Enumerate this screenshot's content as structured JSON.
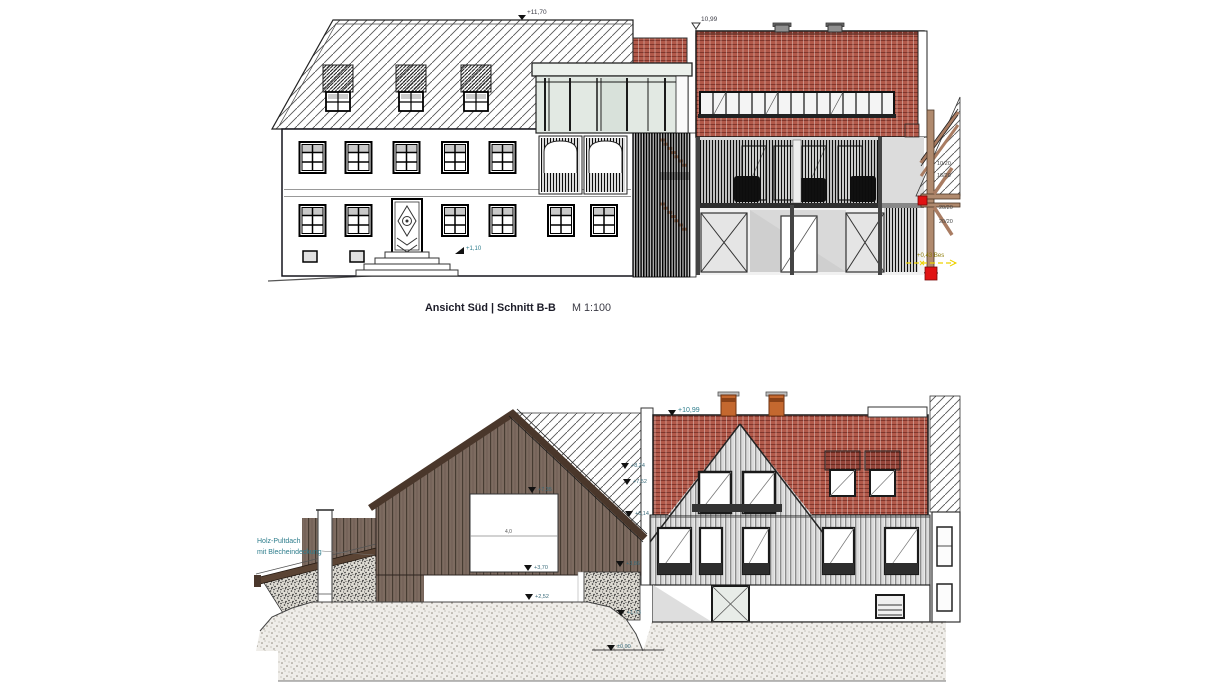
{
  "sheet": {
    "background": "#ffffff"
  },
  "palette": {
    "tile_red": "#b2594a",
    "tile_red_dark": "#96453a",
    "barn_brown": "#7d6b60",
    "roof_edge_brown": "#4a372b",
    "timber_brown": "#b08a6e",
    "marker_teal": "#2e7d8c",
    "highlight_yellow": "#eed202",
    "accent_red": "#e01313",
    "siding_gray": "#8c8c8c"
  },
  "top_drawing": {
    "title": "Ansicht Süd | Schnitt B-B",
    "scale": "M 1:100",
    "levels": {
      "ridge": "+11,70",
      "neighbor": "10,99",
      "entry": "+1,10",
      "bestand": "+0,43 Bes"
    },
    "timber_labels": [
      "10/20",
      "16/20",
      "20/20",
      "20/20"
    ]
  },
  "bottom_drawing": {
    "annotation_line1": "Holz-Pultdach",
    "annotation_line2": "mit Blecheindeckung",
    "levels": {
      "ridge": "+10,99",
      "roof_upper": "+8,24",
      "roof_mid": "+7,52",
      "roof_lower": "+6,14",
      "opening_top": "+7,35",
      "opening_bottom": "+3,70",
      "mound": "+2,52",
      "wall_top": "+3,86",
      "slope": "+1,73",
      "street": "±0,00"
    },
    "dimension_width": "4,0"
  }
}
